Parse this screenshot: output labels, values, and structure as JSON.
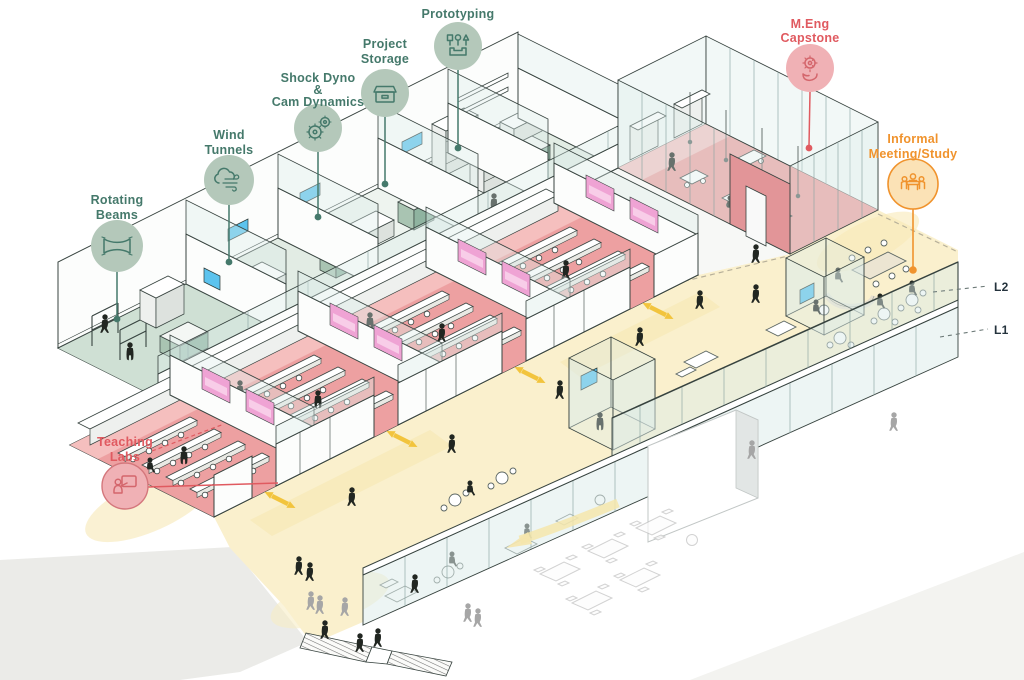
{
  "diagram": {
    "type": "axonometric building program diagram",
    "levels": {
      "l2": {
        "label": "L2"
      },
      "l1": {
        "label": "L1"
      }
    },
    "callouts": {
      "rotating_beams": {
        "line1": "Rotating",
        "line2": "Beams",
        "icon": "rotating-beam-icon",
        "theme": "green"
      },
      "wind_tunnels": {
        "line1": "Wind",
        "line2": "Tunnels",
        "icon": "wind-icon",
        "theme": "green"
      },
      "shock_dyno": {
        "line1": "Shock Dyno",
        "line2": "&",
        "line3": "Cam Dynamics",
        "icon": "gears-icon",
        "theme": "green"
      },
      "project_storage": {
        "line1": "Project",
        "line2": "Storage",
        "icon": "storage-box-icon",
        "theme": "green"
      },
      "prototyping": {
        "line1": "Prototyping",
        "icon": "tools-tray-icon",
        "theme": "green"
      },
      "meng_capstone": {
        "line1": "M.Eng",
        "line2": "Capstone",
        "icon": "gear-in-hand-icon",
        "theme": "red"
      },
      "informal_meeting": {
        "line1": "Informal",
        "line2": "Meeting/Study",
        "icon": "people-at-table-icon",
        "theme": "orange"
      },
      "teaching_labs": {
        "line1": "Teaching",
        "line2": "Labs",
        "icon": "instructor-board-icon",
        "theme": "red"
      }
    }
  },
  "colors": {
    "green-fill": "#b4c8ba",
    "green-ink": "#45796b",
    "red-fill": "#f0b1b5",
    "red-ink": "#e05a60",
    "orange-fill": "#fbe2b6",
    "orange-ink": "#f0932d",
    "level-ink": "#25333d",
    "floor-pink": "#eda0a1",
    "floor-pink-light": "#f5bfbe",
    "wall-pink": "#e29598",
    "screen-magenta": "#efa3d4",
    "floor-yellow": "#faf0cd",
    "glow-yellow": "#f6e6ae",
    "arrow-yellow": "#f2c43d",
    "tv-blue": "#5cc3ee",
    "sage": "#a9c4b2",
    "glass": "#dcecea",
    "ink": "#37433f",
    "ghost": "#bfbfbf",
    "person": "#212621",
    "person-gray": "#a6a6a6"
  }
}
